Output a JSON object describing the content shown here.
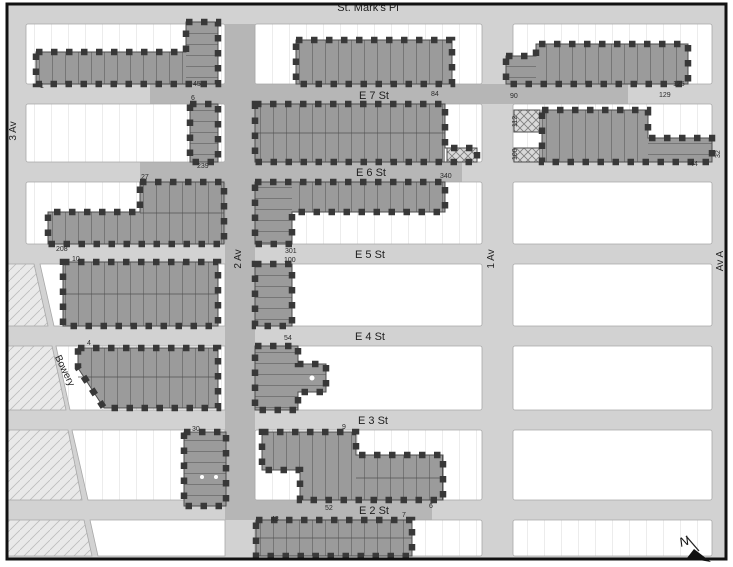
{
  "map": {
    "title": "Historic district tax-lot map",
    "streets": {
      "horizontal": [
        {
          "id": "st-marks",
          "label": "St. Mark's Pl"
        },
        {
          "id": "e7",
          "label": "E 7 St"
        },
        {
          "id": "e6",
          "label": "E 6 St"
        },
        {
          "id": "e5",
          "label": "E 5 St"
        },
        {
          "id": "e4",
          "label": "E 4 St"
        },
        {
          "id": "e3",
          "label": "E 3 St"
        },
        {
          "id": "e2",
          "label": "E 2 St"
        }
      ],
      "vertical": [
        {
          "id": "av3",
          "label": "3 Av"
        },
        {
          "id": "av2",
          "label": "2 Av"
        },
        {
          "id": "av1",
          "label": "1 Av"
        },
        {
          "id": "avA",
          "label": "Av A"
        },
        {
          "id": "bowery",
          "label": "Bowery"
        }
      ]
    },
    "north_arrow_label": "N",
    "address_numbers": [
      {
        "text": "1",
        "x": 40,
        "y": 88
      },
      {
        "text": "45",
        "x": 193,
        "y": 86
      },
      {
        "text": "6",
        "x": 191,
        "y": 100
      },
      {
        "text": "239",
        "x": 197,
        "y": 168
      },
      {
        "text": "27",
        "x": 141,
        "y": 179
      },
      {
        "text": "208",
        "x": 56,
        "y": 251
      },
      {
        "text": "10",
        "x": 72,
        "y": 261
      },
      {
        "text": "84",
        "x": 431,
        "y": 96
      },
      {
        "text": "340",
        "x": 440,
        "y": 178
      },
      {
        "text": "301",
        "x": 285,
        "y": 253
      },
      {
        "text": "100",
        "x": 284,
        "y": 262
      },
      {
        "text": "54",
        "x": 284,
        "y": 340
      },
      {
        "text": "4",
        "x": 87,
        "y": 345
      },
      {
        "text": "30",
        "x": 192,
        "y": 431
      },
      {
        "text": "9",
        "x": 342,
        "y": 429
      },
      {
        "text": "52",
        "x": 325,
        "y": 510
      },
      {
        "text": "43",
        "x": 271,
        "y": 521
      },
      {
        "text": "7",
        "x": 402,
        "y": 517
      },
      {
        "text": "6",
        "x": 429,
        "y": 508
      },
      {
        "text": "90",
        "x": 510,
        "y": 98
      },
      {
        "text": "125",
        "x": 673,
        "y": 86
      },
      {
        "text": "129",
        "x": 659,
        "y": 97
      },
      {
        "text": "112",
        "x": 517,
        "y": 127,
        "rot": -90
      },
      {
        "text": "100",
        "x": 517,
        "y": 160,
        "rot": -90
      },
      {
        "text": "44",
        "x": 690,
        "y": 166
      },
      {
        "text": "32",
        "x": 720,
        "y": 158,
        "rot": -90
      }
    ],
    "colors": {
      "street": "#d2d2d2",
      "street_in_district": "#b6b6b6",
      "district_lot": "#9b9b9b",
      "boundary_dash": "#383838",
      "block": "#ffffff",
      "frame": "#111111"
    }
  }
}
